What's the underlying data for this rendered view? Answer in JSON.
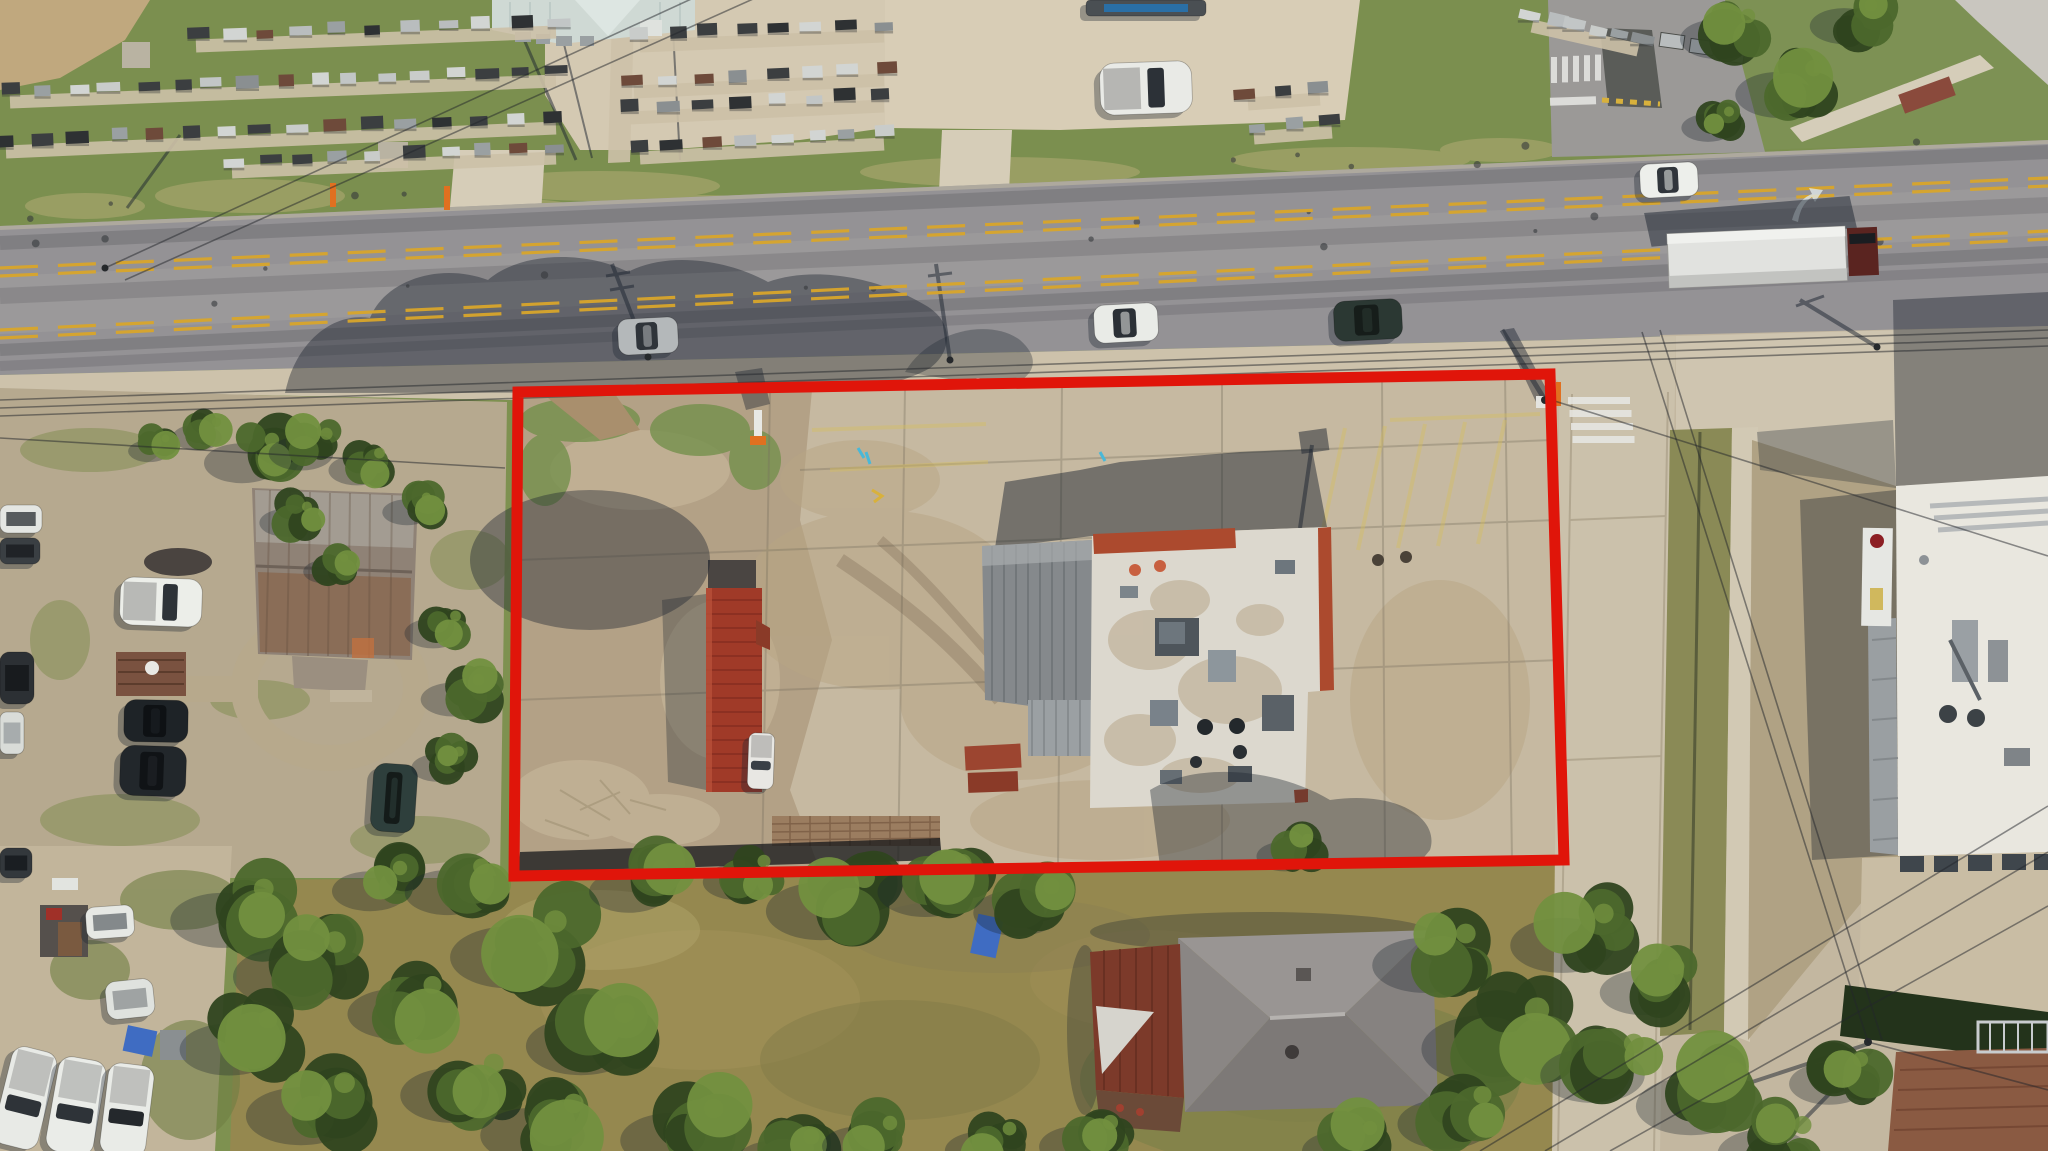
{
  "meta": {
    "image_type": "aerial-drone-photograph",
    "subject": "commercial corner lot outlined in red, flat-roof building with rooftop HVAC, concrete parking lot, two-lane road with double yellow dashed center lines, monument sales yard across road, side street with crosswalks, neighboring houses and white commercial building"
  },
  "palette": {
    "grass_north": "#7b8f4f",
    "verge": "#97a065",
    "asphalt": "#949295",
    "side_street_top": "#9b9997",
    "lane_yellow": "#d9a62b",
    "concrete": "#cdc2ab",
    "concrete_lot": "#c6b9a1",
    "street_concrete": "#cbc1ab",
    "gravel": "#d4c9b2",
    "gravel_neighbor": "#b6a98f",
    "dirt": "#b3a186",
    "field": "#95884f",
    "tree_dark": "#2f451f",
    "tree_mid": "#4c682c",
    "tree_light": "#72903f",
    "shadow": "#1c2430",
    "boundary_red": "#e0150a",
    "roof_white": "#dcd8ce",
    "roof_trim_red": "#ac4a2e",
    "roof_metal": "#85898c",
    "roof_container_red": "#a03a28",
    "roof_rust_house": "#8f8276",
    "roof_gray_house": "#8d8987",
    "roof_brown": "#8a5a42",
    "building_white": "#e9e7df",
    "tarp_blue": "#3f6cc2",
    "monument_strip": "#cdc1a8",
    "orange_post": "#e07020"
  },
  "boundary": {
    "points": "518,392 1550,374 1564,860 514,876",
    "stroke_width": 11
  },
  "scene": {
    "monument_colors": [
      "#3b3e40",
      "#c2c6c6",
      "#9aa0a2",
      "#2e3133",
      "#b9bdbe",
      "#6e4a3a",
      "#c9ccca",
      "#3b3e40",
      "#8a8f91",
      "#d2d5d3"
    ],
    "monument_rows": [
      {
        "x1": 196,
        "y1": 40,
        "x2": 556,
        "y2": 26,
        "n": 11
      },
      {
        "x1": 10,
        "y1": 96,
        "x2": 556,
        "y2": 75,
        "n": 17
      },
      {
        "x1": 6,
        "y1": 146,
        "x2": 556,
        "y2": 122,
        "n": 16
      },
      {
        "x1": 232,
        "y1": 166,
        "x2": 556,
        "y2": 152,
        "n": 10
      },
      {
        "x1": 640,
        "y1": 40,
        "x2": 884,
        "y2": 30,
        "n": 8
      },
      {
        "x1": 634,
        "y1": 86,
        "x2": 884,
        "y2": 74,
        "n": 8
      },
      {
        "x1": 630,
        "y1": 112,
        "x2": 884,
        "y2": 100,
        "n": 8
      },
      {
        "x1": 640,
        "y1": 152,
        "x2": 884,
        "y2": 138,
        "n": 8
      },
      {
        "x1": 1248,
        "y1": 98,
        "x2": 1320,
        "y2": 93,
        "n": 3
      },
      {
        "x1": 1254,
        "y1": 132,
        "x2": 1332,
        "y2": 126,
        "n": 3
      },
      {
        "x1": 1532,
        "y1": 20,
        "x2": 1638,
        "y2": 44,
        "n": 6
      }
    ],
    "trees": [
      [
        262,
        452,
        40
      ],
      [
        318,
        444,
        34
      ],
      [
        372,
        462,
        30
      ],
      [
        420,
        505,
        26
      ],
      [
        300,
        515,
        28
      ],
      [
        338,
        565,
        24
      ],
      [
        448,
        625,
        30
      ],
      [
        470,
        690,
        34
      ],
      [
        452,
        760,
        28
      ],
      [
        210,
        430,
        26
      ],
      [
        160,
        445,
        22
      ],
      [
        250,
        905,
        55
      ],
      [
        320,
        960,
        60
      ],
      [
        255,
        1035,
        52
      ],
      [
        330,
        1100,
        58
      ],
      [
        420,
        1000,
        50
      ],
      [
        480,
        1080,
        55
      ],
      [
        390,
        880,
        40
      ],
      [
        540,
        940,
        62
      ],
      [
        610,
        1030,
        58
      ],
      [
        560,
        1120,
        55
      ],
      [
        470,
        880,
        45
      ],
      [
        650,
        880,
        42
      ],
      [
        755,
        872,
        36
      ],
      [
        850,
        895,
        58
      ],
      [
        950,
        878,
        50
      ],
      [
        1040,
        900,
        46
      ],
      [
        700,
        1125,
        55
      ],
      [
        800,
        1150,
        45
      ],
      [
        880,
        1135,
        40
      ],
      [
        1000,
        1140,
        38
      ],
      [
        1100,
        1135,
        42
      ],
      [
        1452,
        950,
        55
      ],
      [
        1520,
        1030,
        68
      ],
      [
        1590,
        930,
        55
      ],
      [
        1470,
        1110,
        50
      ],
      [
        1360,
        1140,
        40
      ],
      [
        1620,
        1060,
        55
      ],
      [
        1665,
        980,
        45
      ],
      [
        1300,
        848,
        30
      ],
      [
        1720,
        1090,
        58
      ],
      [
        1790,
        1140,
        50
      ],
      [
        1850,
        1072,
        42
      ],
      [
        1738,
        28,
        40
      ],
      [
        1802,
        82,
        46
      ],
      [
        1862,
        16,
        36
      ],
      [
        1722,
        120,
        28
      ]
    ],
    "vehicles": [
      {
        "name": "silver-sedan-on-road",
        "x": 618,
        "y": 318,
        "w": 60,
        "h": 36,
        "rot": -3,
        "body": "#b4b8ba",
        "glass": "#2f343a",
        "kind": "car"
      },
      {
        "name": "white-suv-on-road",
        "x": 1094,
        "y": 304,
        "w": 64,
        "h": 38,
        "rot": -3,
        "body": "#e9ebe7",
        "glass": "#2b3036",
        "kind": "car"
      },
      {
        "name": "dark-green-sedan-on-road",
        "x": 1334,
        "y": 300,
        "w": 68,
        "h": 40,
        "rot": -3,
        "body": "#2b3833",
        "glass": "#161d1a",
        "kind": "car"
      },
      {
        "name": "white-car-on-road-east",
        "x": 1640,
        "y": 163,
        "w": 58,
        "h": 34,
        "rot": -3,
        "body": "#edefeb",
        "glass": "#30353b",
        "kind": "car"
      },
      {
        "name": "white-pickup-north-lot",
        "x": 1100,
        "y": 62,
        "w": 92,
        "h": 52,
        "rot": -2,
        "body": "#e9eae6",
        "glass": "#2c3137",
        "kind": "pickup"
      },
      {
        "name": "equipment-trailer-north",
        "x": 1086,
        "y": 0,
        "w": 120,
        "h": 16,
        "rot": 0,
        "body": "#4a4f53",
        "glass": "#2277bb",
        "kind": "flat"
      },
      {
        "name": "white-pickup-neighbor",
        "x": 120,
        "y": 578,
        "w": 82,
        "h": 48,
        "rot": 2,
        "body": "#eceee9",
        "glass": "#2e3338",
        "kind": "pickup"
      },
      {
        "name": "black-suv-neighbor-1",
        "x": 124,
        "y": 700,
        "w": 64,
        "h": 42,
        "rot": 1,
        "body": "#1e2327",
        "glass": "#0e1114",
        "kind": "car"
      },
      {
        "name": "black-suv-neighbor-2",
        "x": 120,
        "y": 746,
        "w": 66,
        "h": 50,
        "rot": 2,
        "body": "#22272b",
        "glass": "#101316",
        "kind": "car"
      },
      {
        "name": "dark-teal-sedan-neighbor",
        "x": 372,
        "y": 764,
        "w": 44,
        "h": 68,
        "rot": 4,
        "body": "#2e3f3c",
        "glass": "#141b19",
        "kind": "car"
      },
      {
        "name": "white-box-truck-left-edge",
        "x": 0,
        "y": 505,
        "w": 42,
        "h": 28,
        "rot": 0,
        "body": "#e4e6e2",
        "glass": "#33383c",
        "kind": "flat"
      },
      {
        "name": "dark-truck-left-edge",
        "x": 0,
        "y": 538,
        "w": 40,
        "h": 26,
        "rot": 0,
        "body": "#3a3f43",
        "glass": "#1a1d20",
        "kind": "flat"
      },
      {
        "name": "dark-pickup-left-edge",
        "x": 0,
        "y": 652,
        "w": 34,
        "h": 52,
        "rot": 0,
        "body": "#2c3034",
        "glass": "#141719",
        "kind": "flat"
      },
      {
        "name": "white-trailer-left-edge",
        "x": 0,
        "y": 712,
        "w": 24,
        "h": 42,
        "rot": 0,
        "body": "#d9dcd8",
        "glass": "#9aa0a2",
        "kind": "flat"
      },
      {
        "name": "white-pickup-bottom-1",
        "x": 2,
        "y": 1048,
        "w": 46,
        "h": 100,
        "rot": 14,
        "body": "#e8eae6",
        "glass": "#2e3338",
        "kind": "vpickup"
      },
      {
        "name": "white-pickup-bottom-2",
        "x": 52,
        "y": 1058,
        "w": 48,
        "h": 96,
        "rot": 10,
        "body": "#eaece8",
        "glass": "#2e3338",
        "kind": "vpickup"
      },
      {
        "name": "white-pickup-bottom-3",
        "x": 104,
        "y": 1064,
        "w": 46,
        "h": 92,
        "rot": 7,
        "body": "#e9ebe7",
        "glass": "#24282c",
        "kind": "vpickup"
      },
      {
        "name": "white-camper-shell",
        "x": 86,
        "y": 906,
        "w": 48,
        "h": 32,
        "rot": -4,
        "body": "#e6e8e4",
        "glass": "#6b7074",
        "kind": "flat"
      },
      {
        "name": "white-utility-trailer",
        "x": 106,
        "y": 980,
        "w": 48,
        "h": 38,
        "rot": -6,
        "body": "#dfe2de",
        "glass": "#8e9494",
        "kind": "flat"
      },
      {
        "name": "dark-truck-top-left-corner",
        "x": 0,
        "y": 848,
        "w": 32,
        "h": 30,
        "rot": 0,
        "body": "#33383c",
        "glass": "#14181b",
        "kind": "flat"
      },
      {
        "name": "white-truck-inside-parcel",
        "x": 748,
        "y": 733,
        "w": 26,
        "h": 56,
        "rot": 2,
        "body": "#e8e7e3",
        "glass": "#3a4046",
        "kind": "vpickup"
      }
    ],
    "wires": [
      [
        105,
        268,
        700,
        -5
      ],
      [
        125,
        280,
        762,
        -5
      ],
      [
        0,
        400,
        2048,
        330
      ],
      [
        0,
        408,
        2048,
        338
      ],
      [
        0,
        416,
        2048,
        346
      ],
      [
        1545,
        398,
        2048,
        556
      ],
      [
        1642,
        332,
        1868,
        1042
      ],
      [
        1660,
        330,
        1882,
        1040
      ],
      [
        1480,
        1151,
        2048,
        806
      ],
      [
        1545,
        1151,
        2048,
        852
      ],
      [
        1610,
        1151,
        2048,
        906
      ],
      [
        1868,
        1042,
        2048,
        1090
      ],
      [
        0,
        438,
        505,
        468
      ]
    ],
    "crosswalks": [
      {
        "x": 1551,
        "y": 57,
        "n": 5,
        "dx": 11,
        "dy": -0.6,
        "w": 6,
        "h": 26
      },
      {
        "x": 1568,
        "y": 397,
        "n": 4,
        "dx": 1.5,
        "dy": 13,
        "w": 62,
        "h": 7
      }
    ],
    "parking_stripes": [
      [
        812,
        430,
        986,
        424
      ],
      [
        830,
        470,
        988,
        462
      ],
      [
        1345,
        428,
        1318,
        552
      ],
      [
        1385,
        426,
        1358,
        550
      ],
      [
        1425,
        424,
        1398,
        548
      ],
      [
        1465,
        422,
        1438,
        546
      ],
      [
        1505,
        420,
        1478,
        544
      ],
      [
        1390,
        420,
        1540,
        414
      ]
    ],
    "road_specks": {
      "count": 26
    }
  }
}
